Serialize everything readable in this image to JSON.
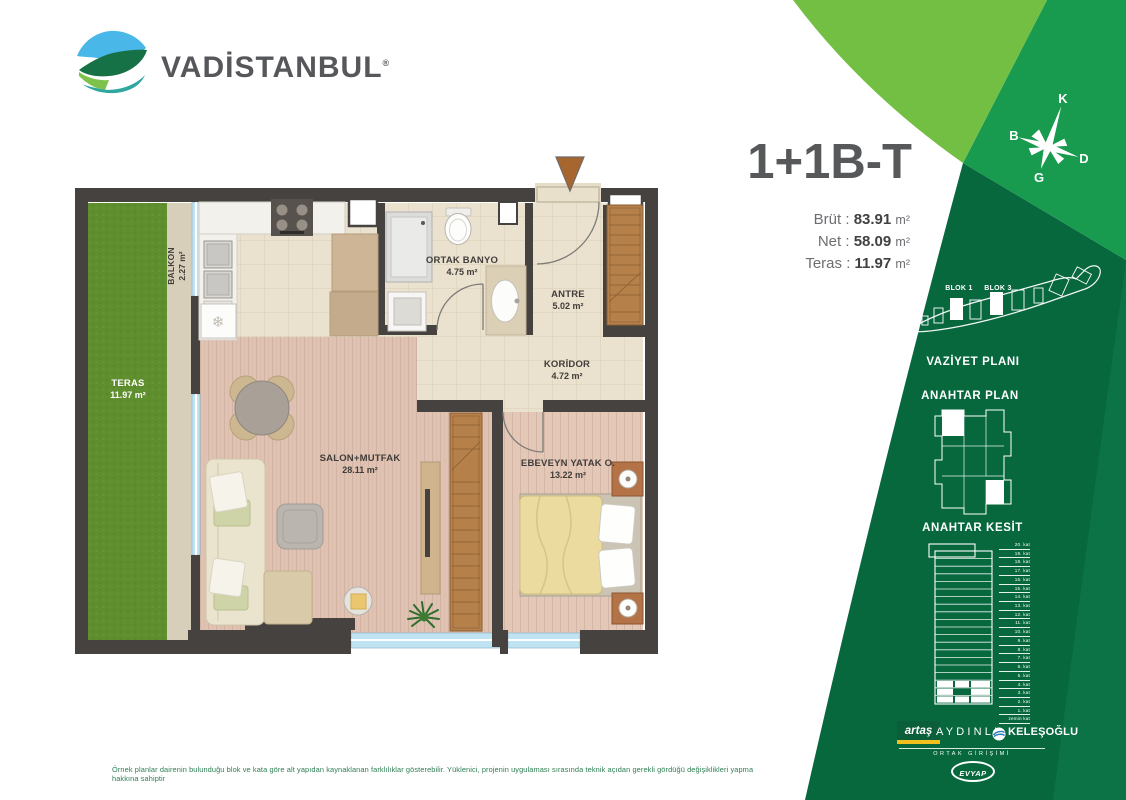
{
  "brand": {
    "name": "VADİSTANBUL",
    "registered": "®"
  },
  "unit": {
    "type_label": "1+1B-T",
    "metrics": [
      {
        "label": "Brüt :",
        "value": "83.91",
        "unit": "m²"
      },
      {
        "label": "Net :",
        "value": "58.09",
        "unit": "m²"
      },
      {
        "label": "Teras :",
        "value": "11.97",
        "unit": "m²"
      }
    ]
  },
  "compass": {
    "k": "K",
    "d": "D",
    "g": "G",
    "b": "B"
  },
  "floorplan": {
    "rooms": [
      {
        "name": "BALKON",
        "area": "2.27 m²"
      },
      {
        "name": "TERAS",
        "area": "11.97 m²"
      },
      {
        "name": "ORTAK BANYO",
        "area": "4.75 m²"
      },
      {
        "name": "ANTRE",
        "area": "5.02 m²"
      },
      {
        "name": "KORİDOR",
        "area": "4.72 m²"
      },
      {
        "name": "SALON+MUTFAK",
        "area": "28.11 m²"
      },
      {
        "name": "EBEVEYN YATAK O.",
        "area": "13.22 m²"
      }
    ]
  },
  "site_plan": {
    "title": "VAZİYET PLANI",
    "block_labels": [
      "BLOK 1",
      "BLOK 3"
    ]
  },
  "key_plan": {
    "title": "ANAHTAR PLAN"
  },
  "key_section": {
    "title": "ANAHTAR KESİT",
    "floors": [
      "20. kat",
      "19. kat",
      "18. kat",
      "17. kat",
      "16. kat",
      "15. kat",
      "14. kat",
      "13. kat",
      "12. kat",
      "11. kat",
      "10. kat",
      "9. kat",
      "8. kat",
      "7. kat",
      "6. kat",
      "5. kat",
      "4. kat",
      "3. kat",
      "2. kat",
      "1. kat",
      "zemin kat"
    ]
  },
  "partners": {
    "artas": "artaş",
    "aydinli": "AYDINLI",
    "kelesoglu": "KELEŞOĞLU",
    "joint_venture": "ORTAK GİRİŞİMİ",
    "evyap": "EVYAP"
  },
  "disclaimer": "Örnek planlar dairenin bulunduğu blok ve kata göre alt yapıdan kaynaklanan farklılıklar gösterebilir. Yüklenici, projenin uygulaması sırasında teknik açıdan gerekli gördüğü değişiklikleri yapma hakkına sahiptir",
  "colors": {
    "dark_green": "#07683e",
    "mid_green": "#189a4f",
    "light_green": "#72bf44",
    "edge_green": "#0b7345",
    "title_gray": "#57585a",
    "teras_green": "#5e8e2e",
    "wall": "#454240",
    "window_blue": "#bfe3f1",
    "cabinet_wood": "#b58049",
    "artas_yellow": "#f2c01d"
  }
}
